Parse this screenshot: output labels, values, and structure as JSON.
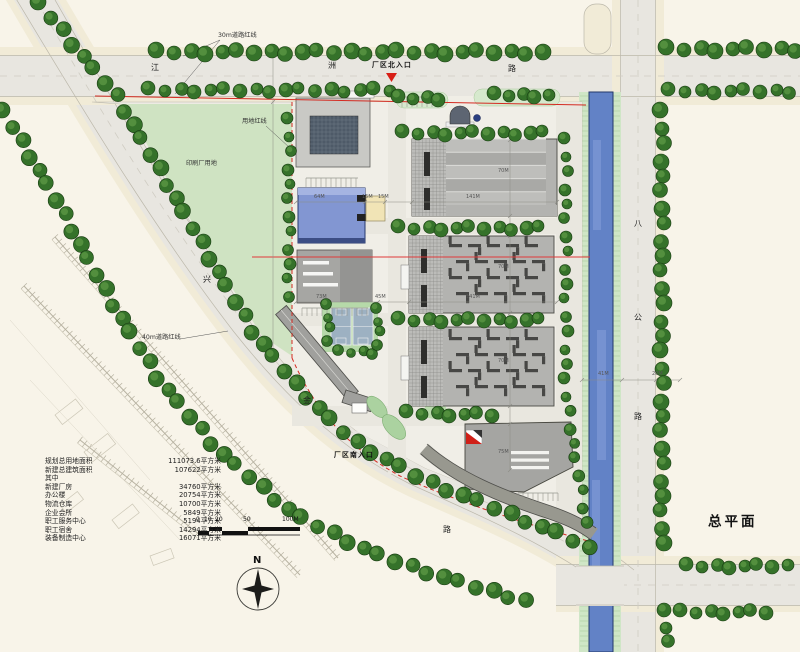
{
  "title": "总平面",
  "roads": {
    "north_road_chars": [
      "江",
      "洲",
      "路"
    ],
    "east_road_chars": [
      "八",
      "公",
      "路"
    ],
    "diagonal_road_chars": [
      "兴",
      "金",
      "路"
    ]
  },
  "entrances": {
    "north": "厂区北入口",
    "south": "厂区南入口"
  },
  "annotations": {
    "road_redline_30m": "30m道路红线",
    "road_redline_40m": "40m道路红线",
    "site_redline": "用地红线",
    "printing_plant_land": "印刷厂用地"
  },
  "legend": {
    "rows": [
      {
        "label": "规划总用地面积",
        "value": "111073.6平方米"
      },
      {
        "label": "新建总建筑面积",
        "value": "107622平方米"
      },
      {
        "label": "其中",
        "value": ""
      },
      {
        "label": "新建厂房",
        "value": "34760平方米"
      },
      {
        "label": "办公楼",
        "value": "20754平方米"
      },
      {
        "label": "物流仓库",
        "value": "10700平方米"
      },
      {
        "label": "企业会所",
        "value": "5849平方米"
      },
      {
        "label": "职工服务中心",
        "value": "5194平方米"
      },
      {
        "label": "职工宿舍",
        "value": "14294平方米"
      },
      {
        "label": "装备制造中心",
        "value": "16071平方米"
      }
    ]
  },
  "scale_bar": {
    "ticks": [
      "0",
      "10",
      "20",
      "50",
      "100M"
    ]
  },
  "compass": {
    "north_label": "N"
  },
  "dimensions": {
    "d64": "64M",
    "d15a": "15M",
    "d15b": "15M",
    "d73": "73M",
    "d45": "45M",
    "d141a": "141M",
    "d141b": "141M",
    "d70a": "70M",
    "d70b": "70M",
    "d70c": "70M",
    "d75": "75M",
    "d41": "41M",
    "d20": "20M"
  },
  "colors": {
    "background": "#f8f4e9",
    "road": "#e8e6e0",
    "sidewalk": "#f1ebd7",
    "green_land": "#cfe3c2",
    "canal_blue": "#6282c6",
    "tree_green": "#35722a",
    "redline": "#d42b22",
    "building_gray": "#b3b3b0",
    "club_blue": "#8296d2",
    "annex_yellow": "#f1e4b6"
  }
}
